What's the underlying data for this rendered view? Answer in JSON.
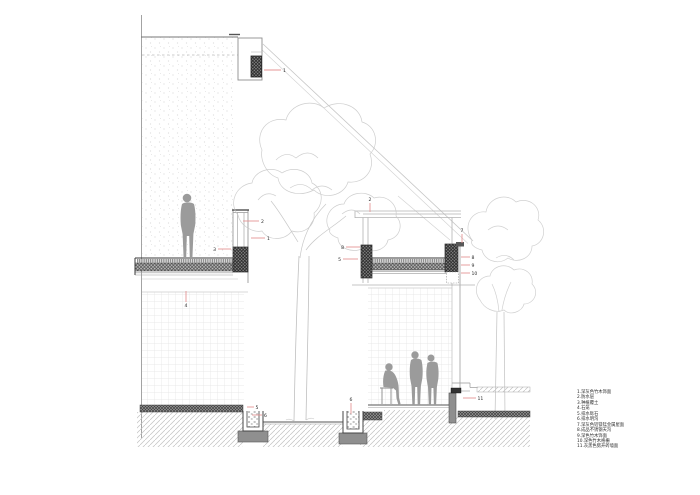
{
  "drawing": {
    "kind": "architectural-section",
    "description": "Sectional detail drawing of sunken courtyard pavilions with green roof, trees and drainage channels"
  },
  "legend": {
    "items": [
      "1.深灰色竹木饰面",
      "2.防水层",
      "3.种植覆土",
      "4.石笼",
      "5.排水砾石",
      "6.排水明沟",
      "7.深灰色铝镁锰金属屋面",
      "8.成品不锈钢天沟",
      "9.深色竹木饰面",
      "10.深色竹木格栅",
      "11.灰黑色劈开砖墙面"
    ]
  },
  "callouts": [
    {
      "n": "1"
    },
    {
      "n": "2"
    },
    {
      "n": "1"
    },
    {
      "n": "3"
    },
    {
      "n": "4"
    },
    {
      "n": "2"
    },
    {
      "n": "7"
    },
    {
      "n": "8"
    },
    {
      "n": "5"
    },
    {
      "n": "8"
    },
    {
      "n": "9"
    },
    {
      "n": "10"
    },
    {
      "n": "5"
    },
    {
      "n": "6"
    },
    {
      "n": "6"
    },
    {
      "n": "11"
    }
  ],
  "colors": {
    "leader": "#e59595",
    "cut_line": "#3a3a3a",
    "light_line": "#bdbdbd",
    "figure": "#9b9b9b",
    "label_text": "#2b2b2b"
  }
}
